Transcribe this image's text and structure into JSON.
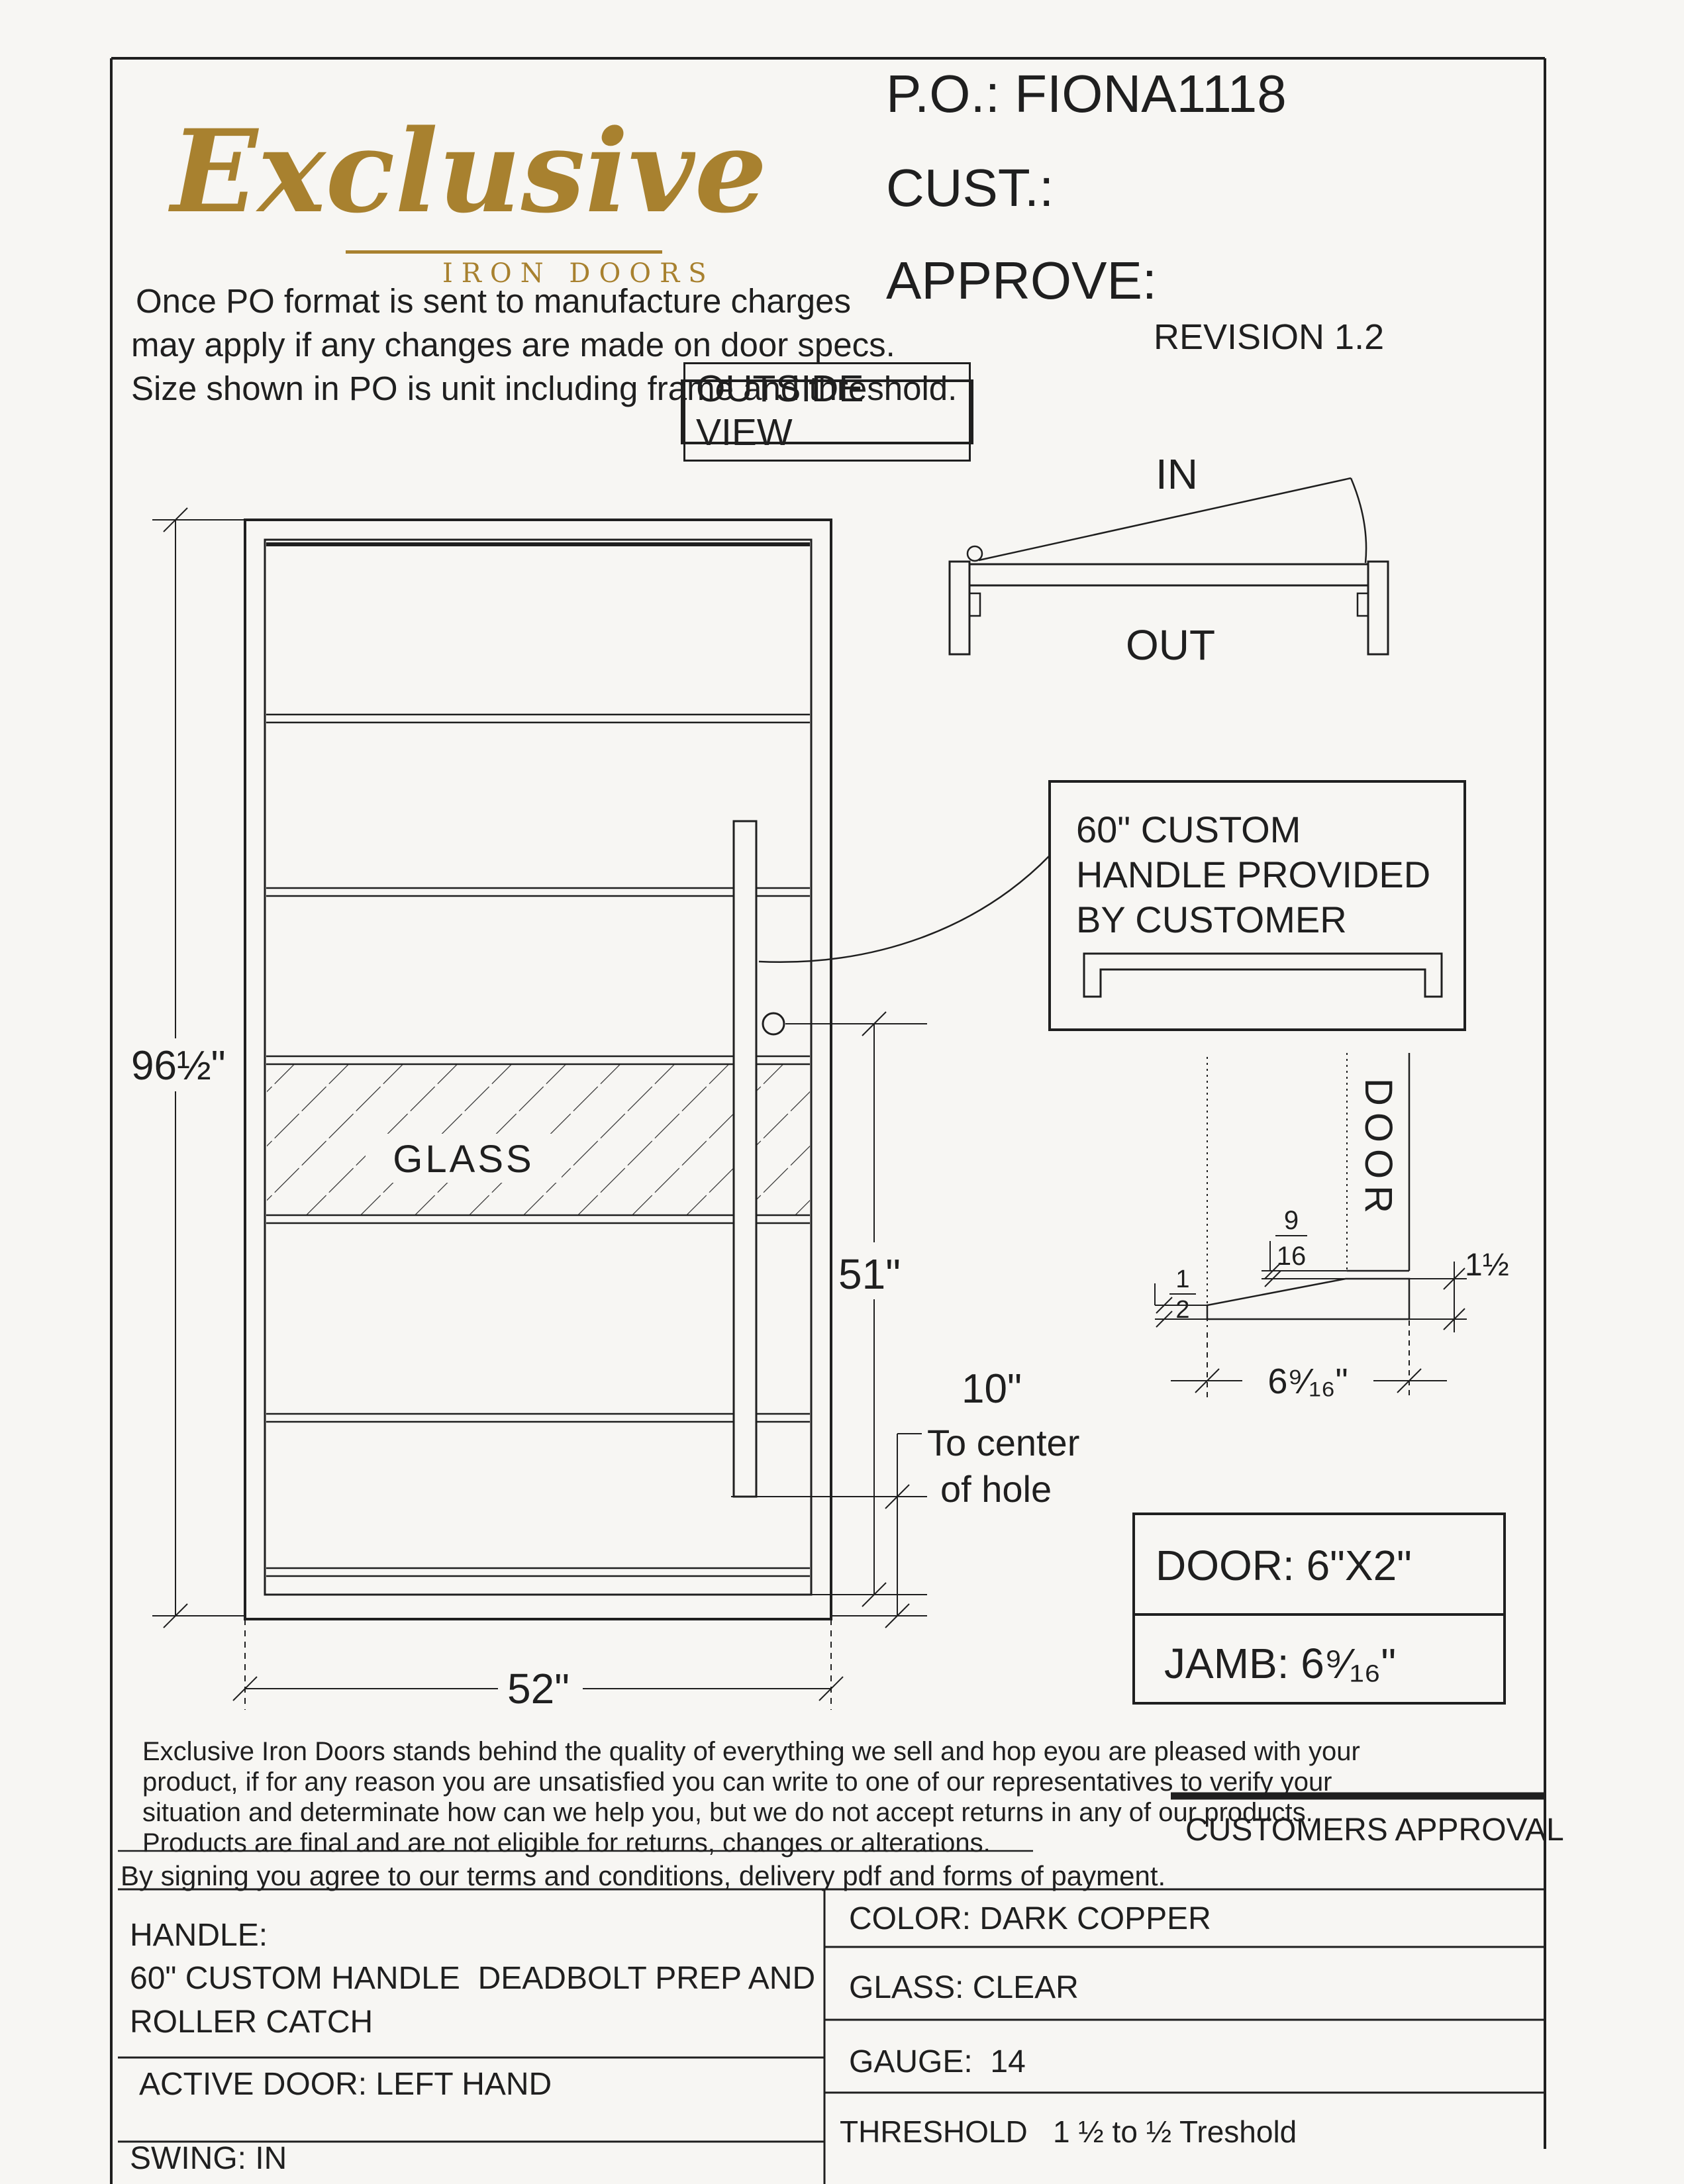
{
  "header": {
    "po": "P.O.: FIONA1118",
    "cust": "CUST.:",
    "approve": "APPROVE:",
    "revision": "REVISION 1.2",
    "note1": "Once PO format is sent to manufacture charges",
    "note2": "may apply if any changes are made on door specs.",
    "note3": "Size shown in PO is unit including frame and threshold.",
    "view_label": "OUTSIDE VIEW"
  },
  "logo": {
    "name": "Exclusive",
    "subtitle": "IRON DOORS"
  },
  "swing": {
    "in_label": "IN",
    "out_label": "OUT"
  },
  "door": {
    "height": "96½\"",
    "width": "52\"",
    "hole_height": "51\"",
    "hole_offset": "10\"",
    "hole_note1": "To center",
    "hole_note2": "of hole",
    "glass": "GLASS"
  },
  "callout": {
    "line1": "60\" CUSTOM",
    "line2": "HANDLE PROVIDED",
    "line3": "BY CUSTOMER"
  },
  "detail": {
    "door_label": "DOOR",
    "gap_num": "9",
    "gap_den": "16",
    "half_num": "1",
    "half_den": "2",
    "height_label": "1½",
    "width_label": "6⁹⁄₁₆\""
  },
  "specs": {
    "door_size": "DOOR: 6\"X2\"",
    "jamb_size": "JAMB: 6⁹⁄₁₆\""
  },
  "legal": {
    "line1": "Exclusive Iron Doors stands behind the quality of everything we sell and hop eyou are pleased with your",
    "line2": "product, if for any reason you are unsatisfied you can write to one of our representatives to verify your",
    "line3": "situation and determinate how can we help you, but we do not accept returns in any of our products.",
    "line4": "Products are final and are not eligible for returns, changes or alterations.",
    "signing": "By signing you agree to our terms and conditions, delivery pdf and forms of payment.",
    "approval": "CUSTOMERS APPROVAL"
  },
  "table": {
    "handle_title": "HANDLE:",
    "handle_line1": "60\" CUSTOM HANDLE  DEADBOLT PREP AND",
    "handle_line2": "ROLLER CATCH",
    "active_door": "ACTIVE DOOR: LEFT HAND",
    "swing": "SWING: IN",
    "color": "COLOR: DARK COPPER",
    "glass": "GLASS: CLEAR",
    "gauge": "GAUGE:  14",
    "threshold": "THRESHOLD   1 ½ to ½ Treshold"
  },
  "colors": {
    "gold": "#a8812f",
    "ink": "#1f1f1f",
    "paper": "#f7f6f3"
  }
}
